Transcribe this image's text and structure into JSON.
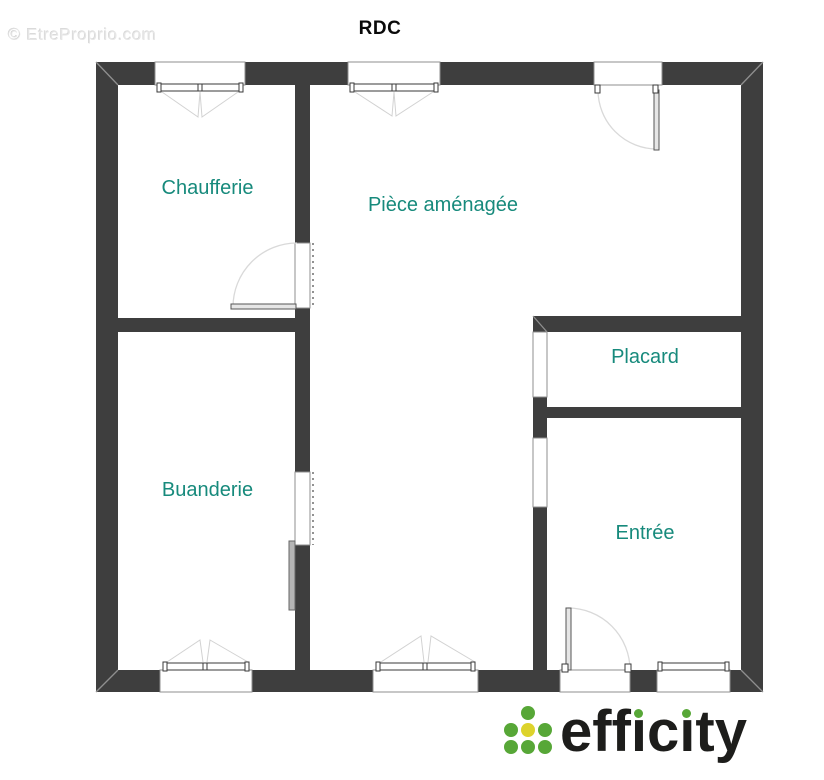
{
  "title": "RDC",
  "watermark": "© EtreProprio.com",
  "rooms": [
    {
      "label": "Chaufferie"
    },
    {
      "label": "Pièce aménagée"
    },
    {
      "label": "Placard"
    },
    {
      "label": "Buanderie"
    },
    {
      "label": "Entrée"
    }
  ],
  "logo": {
    "brand": "efficity",
    "seg_eff": "eff",
    "seg_i": "ı",
    "seg_c": "c",
    "seg_ty": "ty"
  },
  "colors": {
    "wall": "#3e3e3e",
    "room_label": "#178a7c",
    "watermark": "#e6e6e6",
    "opening_stroke": "#8f8f8f",
    "logo_text": "#1d1d1b",
    "logo_green": "#57a737",
    "logo_yellow": "#ddd32c"
  }
}
